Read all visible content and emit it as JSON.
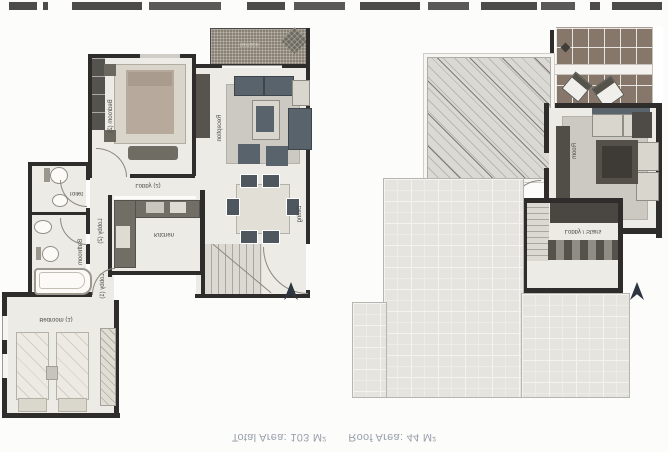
{
  "page": {
    "background": "#fcfcfb"
  },
  "caption": {
    "total_area": "Total Area: 103 M²",
    "roof_area": "Roof Area: 44 M²"
  },
  "floor_plan": {
    "labels": {
      "terrace": "Terrace",
      "reception": "Reception",
      "dining": "Dining",
      "bedroom2": "Bedroom (2)",
      "bedroom1": "Bedroom (1)",
      "lobby2_hall": "Lobby (2)",
      "lobby2_corridor": "Lobby (2)",
      "lobby1": "Lobby (1)",
      "kitchen": "Kitchen",
      "toilet": "Toilet",
      "bathroom": "Bathroom"
    }
  },
  "roof_plan": {
    "labels": {
      "room": "Room",
      "lobby_stairs": "Lobby / Stairs"
    }
  },
  "colors": {
    "wall": "#2e2d2b",
    "floor": "#edebe6",
    "terrace_deck": "#8a8175",
    "pergola": "#87766a",
    "roof_tiles": "#e6e4df",
    "furniture_dark": "#59636b",
    "north_arrow": "#2c3540",
    "caption_text": "#99a0ac"
  }
}
